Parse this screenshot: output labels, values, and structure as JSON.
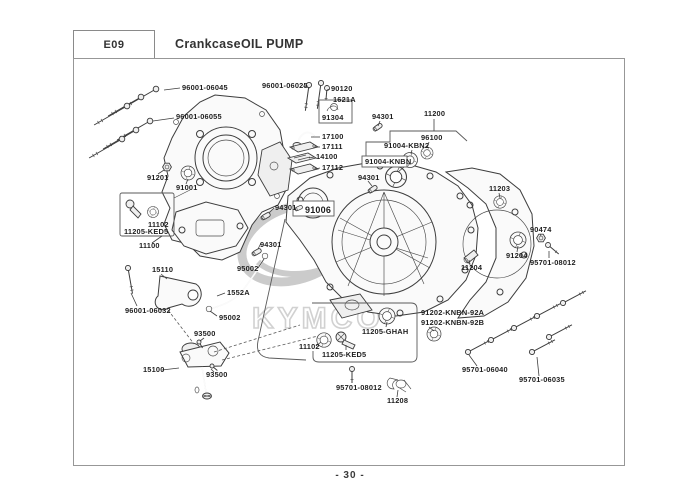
{
  "header": {
    "code": "E09",
    "title": "CrankcaseOIL PUMP"
  },
  "footer": {
    "page_number": "- 30 -"
  },
  "watermark": {
    "text": "KYMCO"
  },
  "diagram": {
    "description": "Exploded parts diagram of crankcase and oil pump",
    "labels": [
      {
        "text": "96001-06045",
        "x": 182,
        "y": 90
      },
      {
        "text": "96001-06055",
        "x": 176,
        "y": 119
      },
      {
        "text": "96001-06025",
        "x": 262,
        "y": 88
      },
      {
        "text": "90120",
        "x": 331,
        "y": 91
      },
      {
        "text": "1621A",
        "x": 333,
        "y": 102
      },
      {
        "text": "91304",
        "x": 322,
        "y": 120
      },
      {
        "text": "17100",
        "x": 322,
        "y": 139
      },
      {
        "text": "17111",
        "x": 322,
        "y": 149
      },
      {
        "text": "14100",
        "x": 316,
        "y": 159
      },
      {
        "text": "17112",
        "x": 322,
        "y": 170
      },
      {
        "text": "94301",
        "x": 372,
        "y": 119
      },
      {
        "text": "11200",
        "x": 424,
        "y": 116
      },
      {
        "text": "96100",
        "x": 421,
        "y": 140
      },
      {
        "text": "91004-KBN2",
        "x": 384,
        "y": 148
      },
      {
        "text": "91004-KNBN",
        "x": 365,
        "y": 164
      },
      {
        "text": "94301",
        "x": 358,
        "y": 180
      },
      {
        "text": "91201",
        "x": 147,
        "y": 180
      },
      {
        "text": "91001",
        "x": 176,
        "y": 190
      },
      {
        "text": "11102",
        "x": 148,
        "y": 227
      },
      {
        "text": "11205-KED5",
        "x": 124,
        "y": 234
      },
      {
        "text": "11100",
        "x": 139,
        "y": 248
      },
      {
        "text": "94301",
        "x": 275,
        "y": 210
      },
      {
        "text": "91006",
        "x": 305,
        "y": 213,
        "big": true
      },
      {
        "text": "94301",
        "x": 260,
        "y": 247
      },
      {
        "text": "95002",
        "x": 237,
        "y": 271
      },
      {
        "text": "15110",
        "x": 152,
        "y": 272
      },
      {
        "text": "1552A",
        "x": 227,
        "y": 295
      },
      {
        "text": "96001-06032",
        "x": 125,
        "y": 313
      },
      {
        "text": "95002",
        "x": 219,
        "y": 320
      },
      {
        "text": "93500",
        "x": 194,
        "y": 336
      },
      {
        "text": "15100",
        "x": 143,
        "y": 372
      },
      {
        "text": "93500",
        "x": 206,
        "y": 377
      },
      {
        "text": "11203",
        "x": 489,
        "y": 191
      },
      {
        "text": "90474",
        "x": 530,
        "y": 232
      },
      {
        "text": "91204",
        "x": 506,
        "y": 258
      },
      {
        "text": "95701-08012",
        "x": 530,
        "y": 265
      },
      {
        "text": "11204",
        "x": 461,
        "y": 270
      },
      {
        "text": "11205-GHAH",
        "x": 362,
        "y": 334
      },
      {
        "text": "11102",
        "x": 299,
        "y": 349
      },
      {
        "text": "11205-KED5",
        "x": 322,
        "y": 357
      },
      {
        "text": "91202-KNBN-92A",
        "x": 421,
        "y": 315
      },
      {
        "text": "91202-KNBN-92B",
        "x": 421,
        "y": 325
      },
      {
        "text": "95701-08012",
        "x": 336,
        "y": 390
      },
      {
        "text": "11208",
        "x": 387,
        "y": 403
      },
      {
        "text": "95701-06040",
        "x": 462,
        "y": 372
      },
      {
        "text": "95701-06035",
        "x": 519,
        "y": 382
      }
    ]
  }
}
